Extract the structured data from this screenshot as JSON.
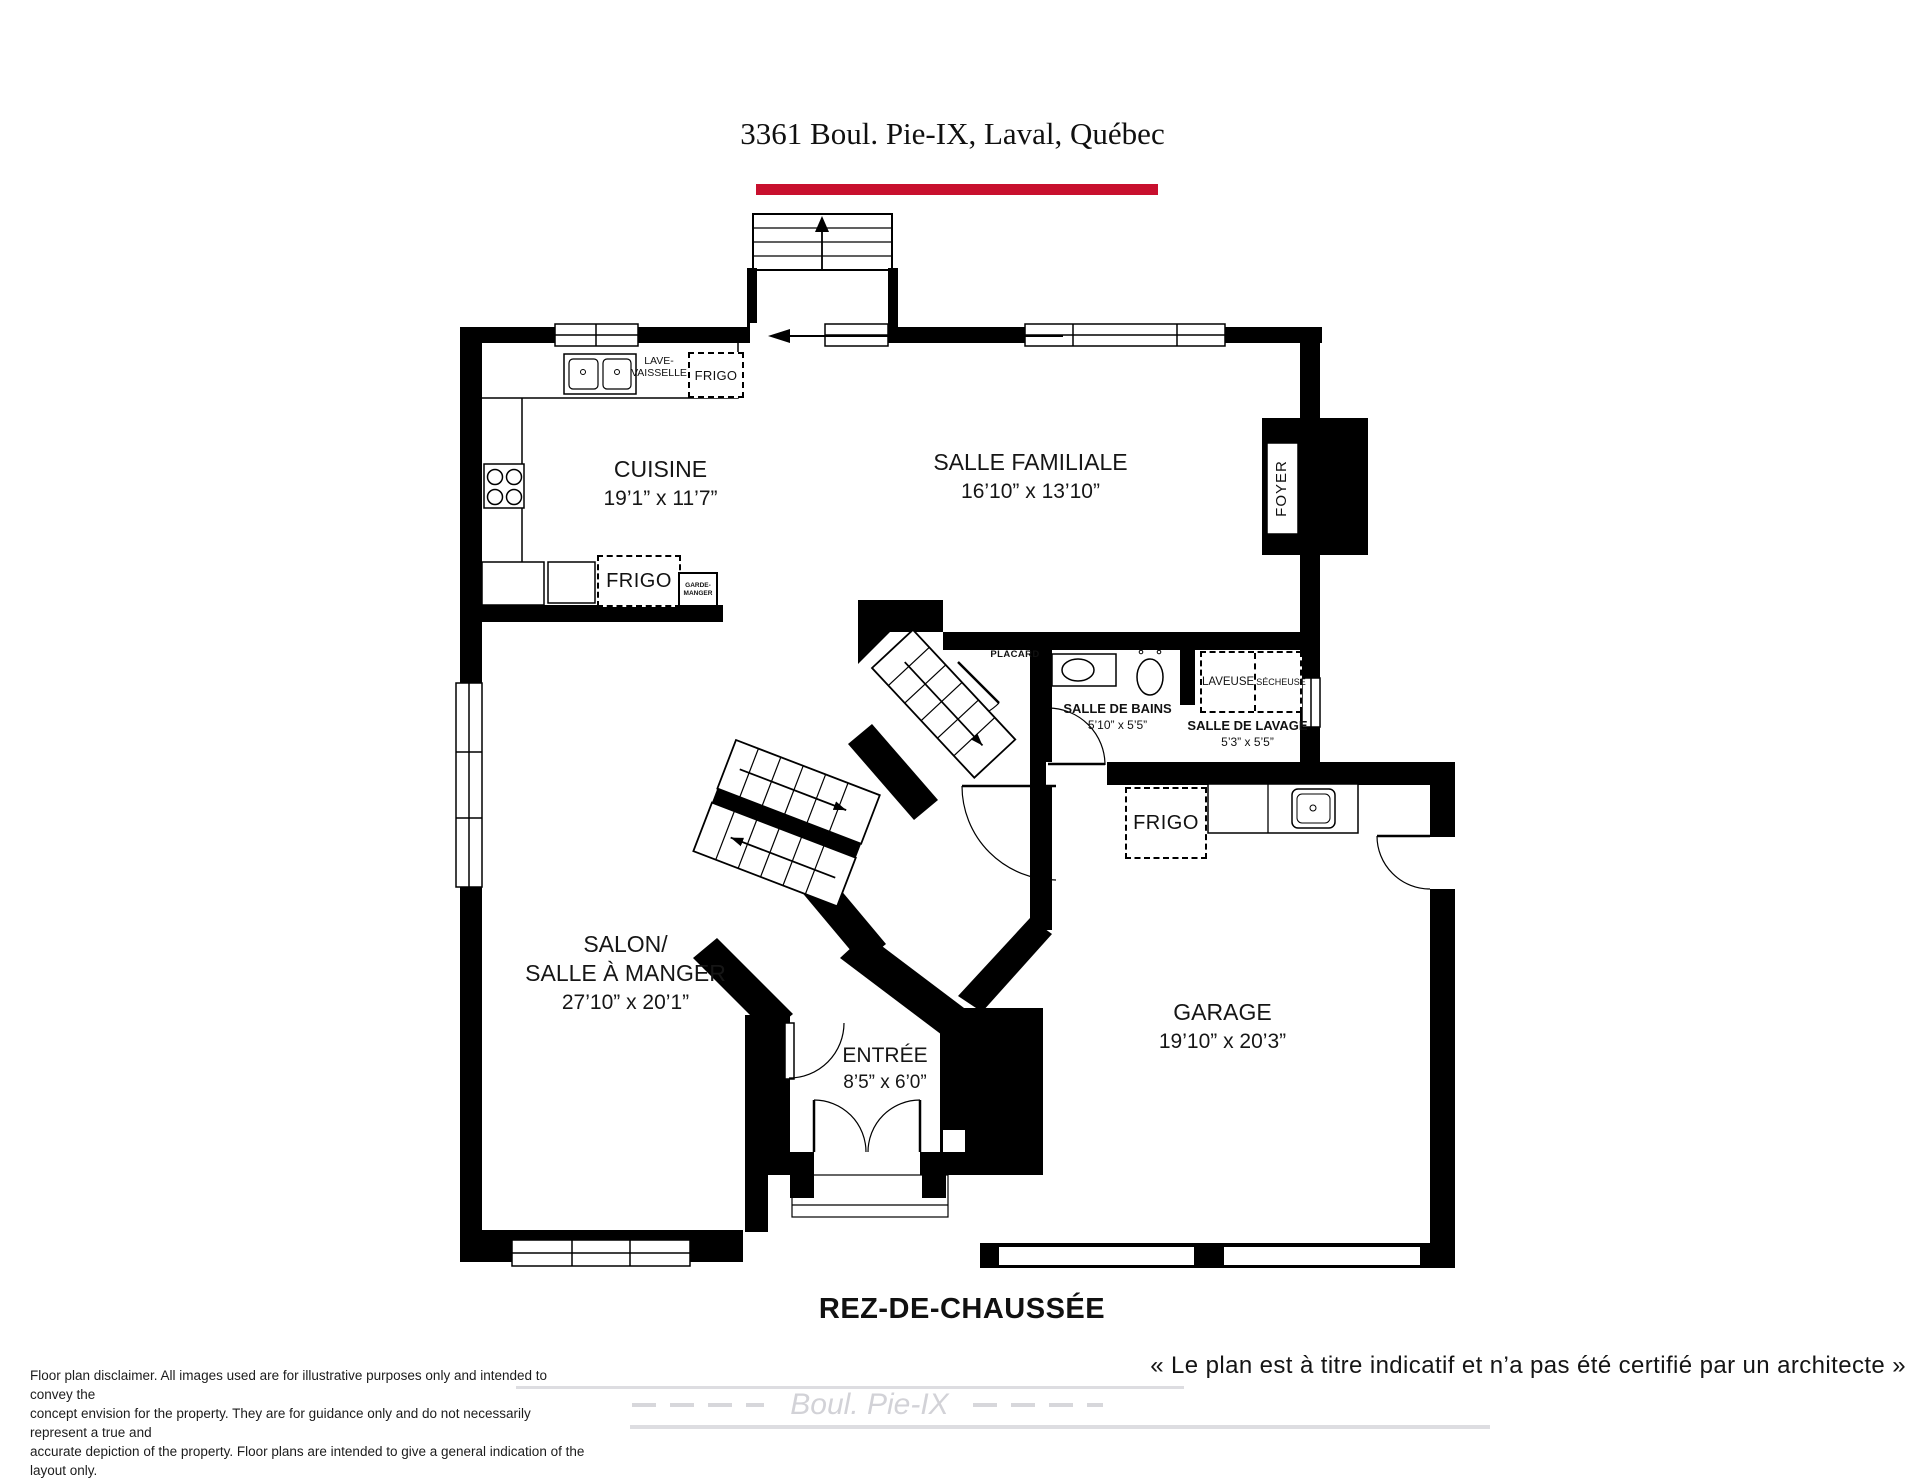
{
  "title": "3361 Boul. Pie-IX, Laval, Québec",
  "floor_label": "REZ-DE-CHAUSSÉE",
  "quote": "« Le plan est à titre indicatif et n’a pas été certifié par un architecte »",
  "watermark_street": "Boul. Pie-IX",
  "disclaimer": {
    "line1": "Floor plan disclaimer. All images used are for illustrative purposes only and intended to convey the",
    "line2": "concept envision for the property. They are for guidance only and do not necessarily represent a true and",
    "line3": "accurate depiction of the property. Floor plans are intended to give a general indication of the layout only.",
    "line4": "All images and dimensions are not intended to form any contract or warranty."
  },
  "rooms": {
    "cuisine": {
      "name": "CUISINE",
      "dims": "19’1” x 11’7”"
    },
    "salle_familiale": {
      "name": "SALLE FAMILIALE",
      "dims": "16’10” x 13’10”"
    },
    "salon": {
      "line1": "SALON/",
      "line2": "SALLE À MANGER",
      "dims": "27’10” x 20’1”"
    },
    "entree": {
      "name": "ENTRÉE",
      "dims": "8’5” x 6’0”"
    },
    "garage": {
      "name": "GARAGE",
      "dims": "19’10” x 20’3”"
    },
    "salle_de_bains": {
      "name": "SALLE DE BAINS",
      "dims": "5’10” x 5’5”"
    },
    "salle_de_lavage": {
      "name": "SALLE DE LAVAGE",
      "dims": "5’3” x 5’5”"
    },
    "foyer": "FOYER",
    "placard": "PLACARD"
  },
  "appliances": {
    "frigo_cuisine_haut": "FRIGO",
    "lave_vaisselle_l1": "LAVE-",
    "lave_vaisselle_l2": "VAISSELLE",
    "frigo_cuisine_bas": "FRIGO",
    "garde_manger_l1": "GARDE-",
    "garde_manger_l2": "MANGER",
    "laveuse": "LAVEUSE",
    "secheuse": "SÉCHEUSE",
    "frigo_garage": "FRIGO"
  },
  "colors": {
    "accent_red": "#c8102e",
    "wall_black": "#000000",
    "watermark_gray": "#d7d7db"
  }
}
